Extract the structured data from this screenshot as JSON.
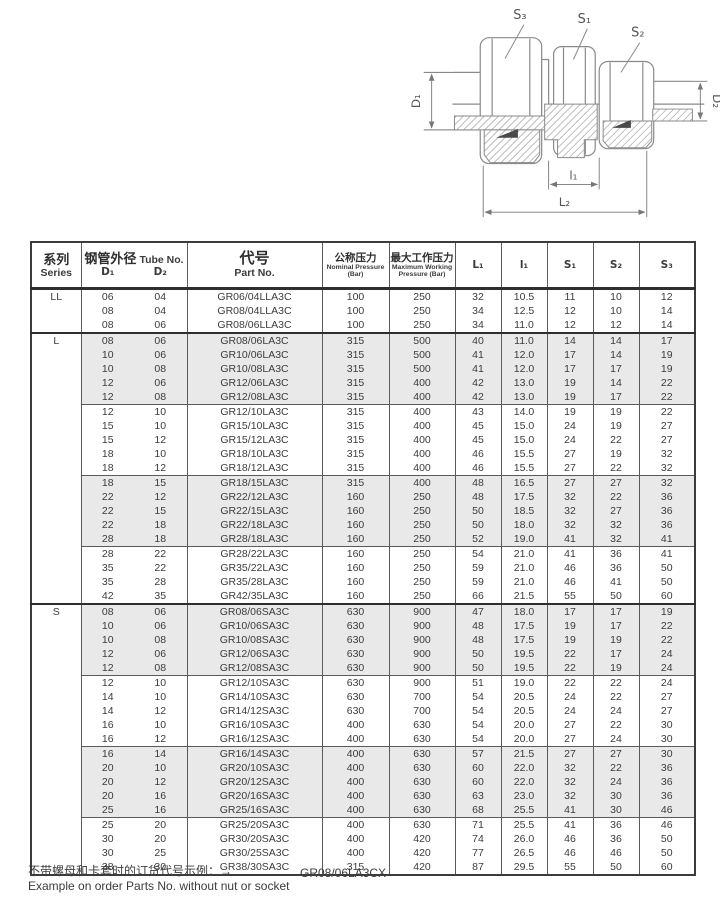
{
  "drawing": {
    "labels": {
      "s3": "S₃",
      "s1": "S₁",
      "s2": "S₂",
      "d1": "D₁",
      "d2": "D₂",
      "l1": "l₁",
      "l2": "L₂"
    }
  },
  "table": {
    "headers": {
      "series_zh": "系列",
      "series_en": "Series",
      "tube_zh": "钢管外径",
      "tube_en": "Tube No.",
      "d1": "D₁",
      "d2": "D₂",
      "part_zh": "代号",
      "part_en": "Part No.",
      "nominal_zh": "公称压力",
      "nominal_en": "Nominal Pressure (Bar)",
      "max_zh": "最大工作压力",
      "max_en": "Maximum Working Pressure (Bar)",
      "l1": "L₁",
      "i1": "l₁",
      "s1": "S₁",
      "s2": "S₂",
      "s3": "S₃"
    },
    "sections": [
      {
        "series": "LL",
        "blocks": [
          {
            "shaded": false,
            "rows": [
              [
                "06",
                "04",
                "GR06/04LLA3C",
                "100",
                "250",
                "32",
                "10.5",
                "11",
                "10",
                "12"
              ],
              [
                "08",
                "04",
                "GR08/04LLA3C",
                "100",
                "250",
                "34",
                "12.5",
                "12",
                "10",
                "14"
              ],
              [
                "08",
                "06",
                "GR08/06LLA3C",
                "100",
                "250",
                "34",
                "11.0",
                "12",
                "12",
                "14"
              ]
            ]
          }
        ]
      },
      {
        "series": "L",
        "blocks": [
          {
            "shaded": true,
            "rows": [
              [
                "08",
                "06",
                "GR08/06LA3C",
                "315",
                "500",
                "40",
                "11.0",
                "14",
                "14",
                "17"
              ],
              [
                "10",
                "06",
                "GR10/06LA3C",
                "315",
                "500",
                "41",
                "12.0",
                "17",
                "14",
                "19"
              ],
              [
                "10",
                "08",
                "GR10/08LA3C",
                "315",
                "500",
                "41",
                "12.0",
                "17",
                "17",
                "19"
              ],
              [
                "12",
                "06",
                "GR12/06LA3C",
                "315",
                "400",
                "42",
                "13.0",
                "19",
                "14",
                "22"
              ],
              [
                "12",
                "08",
                "GR12/08LA3C",
                "315",
                "400",
                "42",
                "13.0",
                "19",
                "17",
                "22"
              ]
            ]
          },
          {
            "shaded": false,
            "rows": [
              [
                "12",
                "10",
                "GR12/10LA3C",
                "315",
                "400",
                "43",
                "14.0",
                "19",
                "19",
                "22"
              ],
              [
                "15",
                "10",
                "GR15/10LA3C",
                "315",
                "400",
                "45",
                "15.0",
                "24",
                "19",
                "27"
              ],
              [
                "15",
                "12",
                "GR15/12LA3C",
                "315",
                "400",
                "45",
                "15.0",
                "24",
                "22",
                "27"
              ],
              [
                "18",
                "10",
                "GR18/10LA3C",
                "315",
                "400",
                "46",
                "15.5",
                "27",
                "19",
                "32"
              ],
              [
                "18",
                "12",
                "GR18/12LA3C",
                "315",
                "400",
                "46",
                "15.5",
                "27",
                "22",
                "32"
              ]
            ]
          },
          {
            "shaded": true,
            "rows": [
              [
                "18",
                "15",
                "GR18/15LA3C",
                "315",
                "400",
                "48",
                "16.5",
                "27",
                "27",
                "32"
              ],
              [
                "22",
                "12",
                "GR22/12LA3C",
                "160",
                "250",
                "48",
                "17.5",
                "32",
                "22",
                "36"
              ],
              [
                "22",
                "15",
                "GR22/15LA3C",
                "160",
                "250",
                "50",
                "18.5",
                "32",
                "27",
                "36"
              ],
              [
                "22",
                "18",
                "GR22/18LA3C",
                "160",
                "250",
                "50",
                "18.0",
                "32",
                "32",
                "36"
              ],
              [
                "28",
                "18",
                "GR28/18LA3C",
                "160",
                "250",
                "52",
                "19.0",
                "41",
                "32",
                "41"
              ]
            ]
          },
          {
            "shaded": false,
            "rows": [
              [
                "28",
                "22",
                "GR28/22LA3C",
                "160",
                "250",
                "54",
                "21.0",
                "41",
                "36",
                "41"
              ],
              [
                "35",
                "22",
                "GR35/22LA3C",
                "160",
                "250",
                "59",
                "21.0",
                "46",
                "36",
                "50"
              ],
              [
                "35",
                "28",
                "GR35/28LA3C",
                "160",
                "250",
                "59",
                "21.0",
                "46",
                "41",
                "50"
              ],
              [
                "42",
                "35",
                "GR42/35LA3C",
                "160",
                "250",
                "66",
                "21.5",
                "55",
                "50",
                "60"
              ]
            ]
          }
        ]
      },
      {
        "series": "S",
        "blocks": [
          {
            "shaded": true,
            "rows": [
              [
                "08",
                "06",
                "GR08/06SA3C",
                "630",
                "900",
                "47",
                "18.0",
                "17",
                "17",
                "19"
              ],
              [
                "10",
                "06",
                "GR10/06SA3C",
                "630",
                "900",
                "48",
                "17.5",
                "19",
                "17",
                "22"
              ],
              [
                "10",
                "08",
                "GR10/08SA3C",
                "630",
                "900",
                "48",
                "17.5",
                "19",
                "19",
                "22"
              ],
              [
                "12",
                "06",
                "GR12/06SA3C",
                "630",
                "900",
                "50",
                "19.5",
                "22",
                "17",
                "24"
              ],
              [
                "12",
                "08",
                "GR12/08SA3C",
                "630",
                "900",
                "50",
                "19.5",
                "22",
                "19",
                "24"
              ]
            ]
          },
          {
            "shaded": false,
            "rows": [
              [
                "12",
                "10",
                "GR12/10SA3C",
                "630",
                "900",
                "51",
                "19.0",
                "22",
                "22",
                "24"
              ],
              [
                "14",
                "10",
                "GR14/10SA3C",
                "630",
                "700",
                "54",
                "20.5",
                "24",
                "22",
                "27"
              ],
              [
                "14",
                "12",
                "GR14/12SA3C",
                "630",
                "700",
                "54",
                "20.5",
                "24",
                "24",
                "27"
              ],
              [
                "16",
                "10",
                "GR16/10SA3C",
                "400",
                "630",
                "54",
                "20.0",
                "27",
                "22",
                "30"
              ],
              [
                "16",
                "12",
                "GR16/12SA3C",
                "400",
                "630",
                "54",
                "20.0",
                "27",
                "24",
                "30"
              ]
            ]
          },
          {
            "shaded": true,
            "rows": [
              [
                "16",
                "14",
                "GR16/14SA3C",
                "400",
                "630",
                "57",
                "21.5",
                "27",
                "27",
                "30"
              ],
              [
                "20",
                "10",
                "GR20/10SA3C",
                "400",
                "630",
                "60",
                "22.0",
                "32",
                "22",
                "36"
              ],
              [
                "20",
                "12",
                "GR20/12SA3C",
                "400",
                "630",
                "60",
                "22.0",
                "32",
                "24",
                "36"
              ],
              [
                "20",
                "16",
                "GR20/16SA3C",
                "400",
                "630",
                "63",
                "23.0",
                "32",
                "30",
                "36"
              ],
              [
                "25",
                "16",
                "GR25/16SA3C",
                "400",
                "630",
                "68",
                "25.5",
                "41",
                "30",
                "46"
              ]
            ]
          },
          {
            "shaded": false,
            "rows": [
              [
                "25",
                "20",
                "GR25/20SA3C",
                "400",
                "630",
                "71",
                "25.5",
                "41",
                "36",
                "46"
              ],
              [
                "30",
                "20",
                "GR30/20SA3C",
                "400",
                "420",
                "74",
                "26.0",
                "46",
                "36",
                "50"
              ],
              [
                "30",
                "25",
                "GR30/25SA3C",
                "400",
                "420",
                "77",
                "26.5",
                "46",
                "46",
                "50"
              ],
              [
                "38",
                "30",
                "GR38/30SA3C",
                "315",
                "420",
                "87",
                "29.5",
                "55",
                "50",
                "60"
              ]
            ]
          }
        ]
      }
    ]
  },
  "footer": {
    "note_zh": "不带螺母和卡套时的订货代号示例：→",
    "note_en": "Example on order Parts No. without nut or socket",
    "example_code": "GR08/06LA3CX"
  }
}
